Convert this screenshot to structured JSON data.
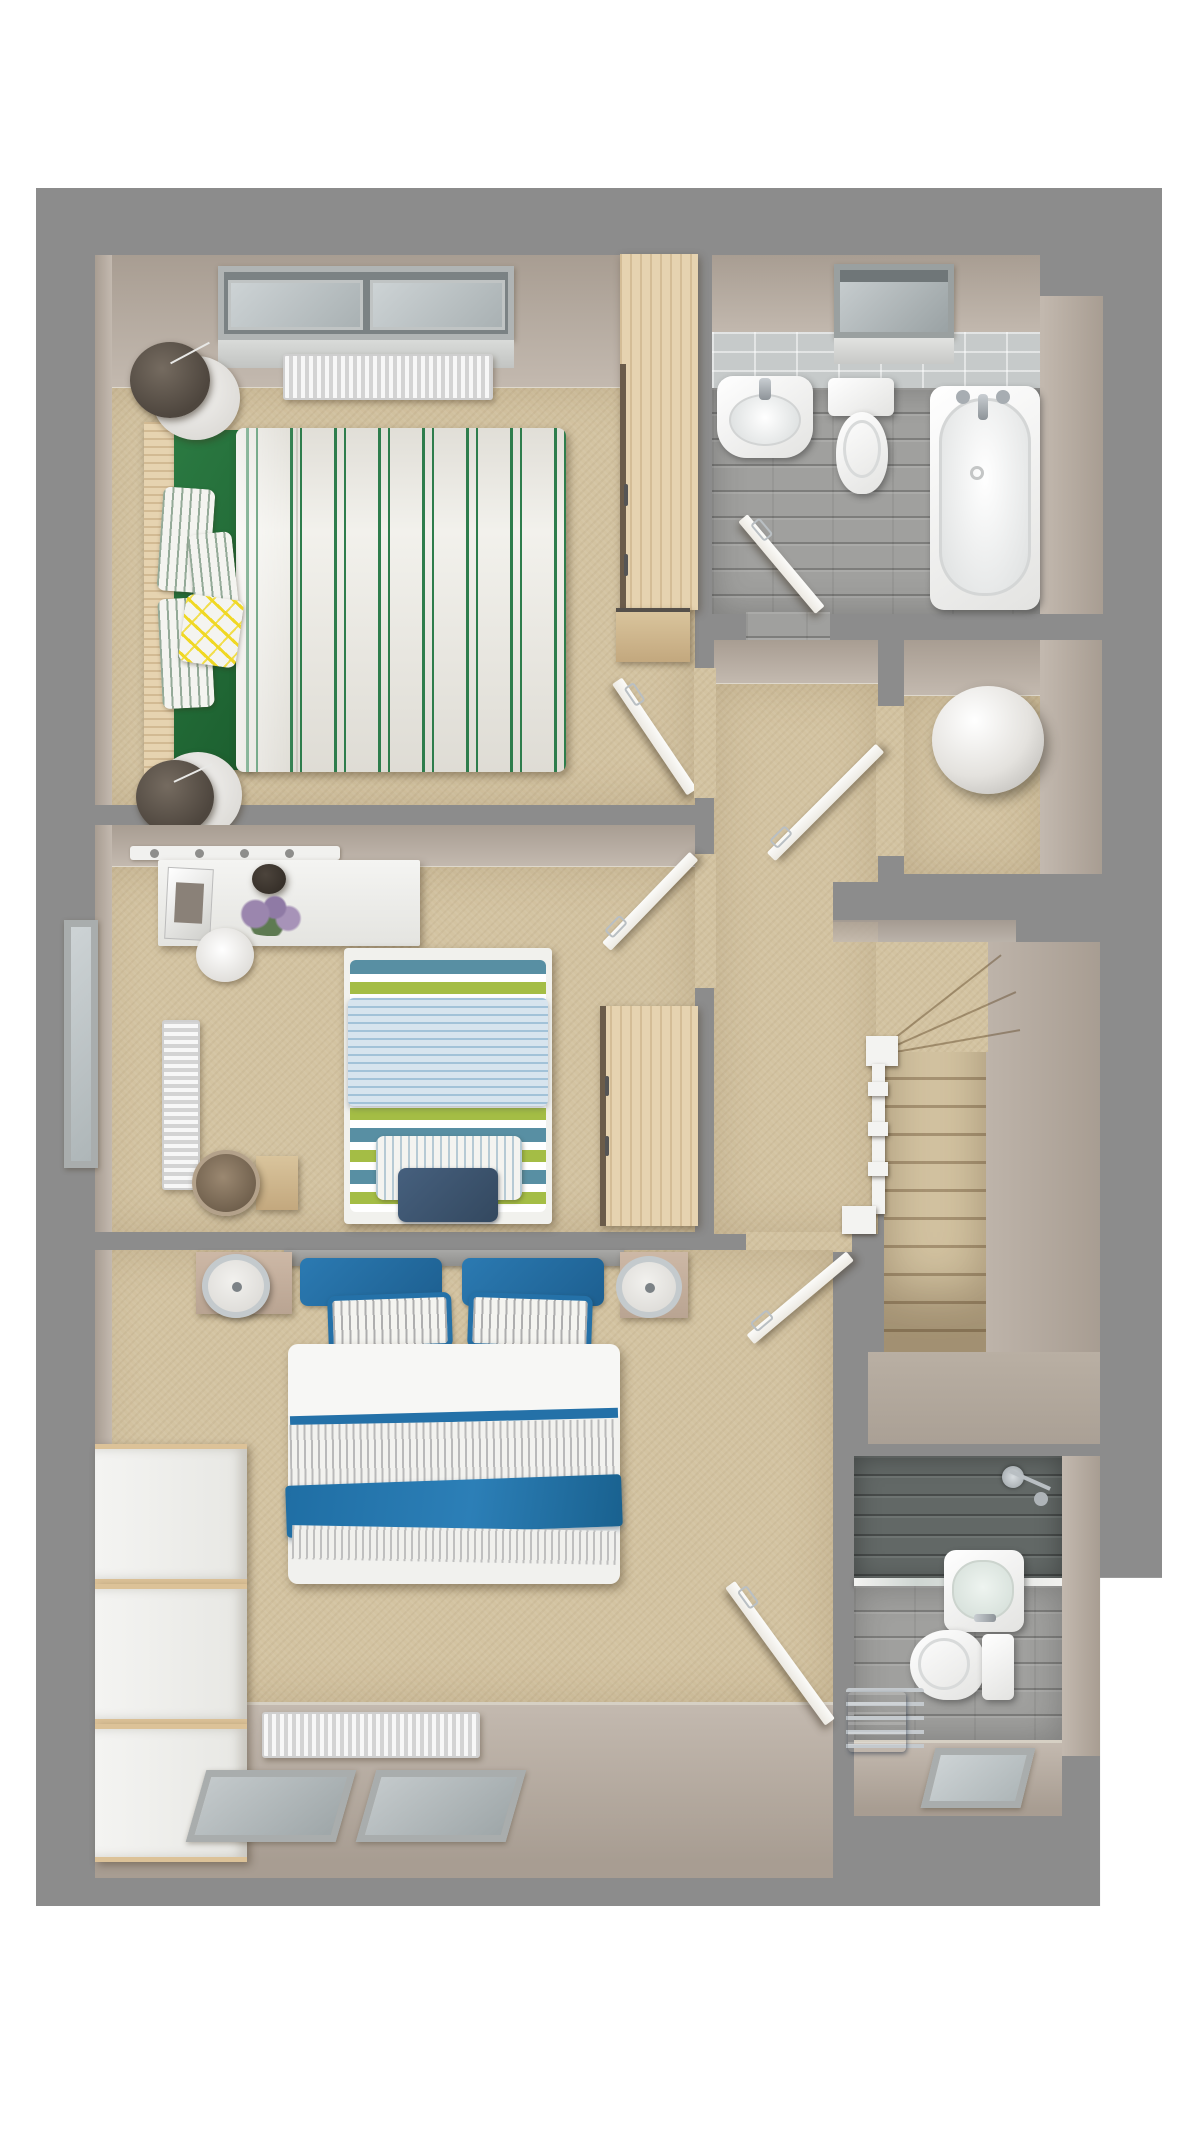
{
  "title": "3D first-floor plan render",
  "palette": {
    "background": "#ffffff",
    "slab": "#8c8c8c",
    "wall_face_dark": "#a89d92",
    "wall_face_light": "#c3b9af",
    "carpet": "#d3c3a1",
    "landing_floor": "#b6aca0",
    "bathroom_plank_floor": "#a0a09e",
    "bathroom_wall_tile": "#c6caca",
    "shower_tile": "#626866",
    "wood_furniture": "#e6d3b0",
    "wood_dark": "#caa97c",
    "duvet_white": "#f6f6f4",
    "stripe_green": "#2e7d4c",
    "sheet_green": "#1f6d35",
    "accent_yellow": "#f0d824",
    "stripe_teal": "#588fa3",
    "stripe_olive": "#a4bd45",
    "quilt_light_blue": "#d3e2ec",
    "cushion_navy": "#3a516b",
    "accent_blue": "#2471a8",
    "towel_blue": "#3f6fb0",
    "chrome": "#b9bfc3",
    "window_glass": "#c3c9cb",
    "window_frame": "#a9adad"
  },
  "rooms": [
    {
      "id": "bedroom-green",
      "furniture": [
        "dormer-window",
        "radiator",
        "double-bed-green-striped-duvet",
        "green-fitted-sheet",
        "striped-pillows",
        "yellow-doodle-cushion",
        "wood-headboard",
        "round-marble-bedside-table-2x",
        "dark-shade-lamp-2x",
        "wood-wardrobe",
        "open-door"
      ]
    },
    {
      "id": "bathroom",
      "furniture": [
        "skylight-window",
        "tiled-wall",
        "pedestal-basin",
        "toilet",
        "bathtub",
        "chrome-taps",
        "plank-tile-floor",
        "open-door"
      ]
    },
    {
      "id": "landing",
      "furniture": [
        "carpet",
        "open-doors",
        "white-balustrade",
        "newel-posts"
      ]
    },
    {
      "id": "airing-cupboard",
      "furniture": [
        "hot-water-cylinder-sphere",
        "open-door"
      ]
    },
    {
      "id": "staircase",
      "furniture": [
        "winder-steps",
        "straight-flight",
        "half-landing",
        "white-handrail"
      ]
    },
    {
      "id": "bedroom-single",
      "furniture": [
        "desk-with-magazine-plant-flowers",
        "knob-rail",
        "round-stool",
        "left-window",
        "vertical-radiator",
        "single-bed-teal-olive-stripes",
        "light-blue-quilt",
        "navy-cushion",
        "wood-wardrobe",
        "woven-basket",
        "side-table",
        "open-door"
      ]
    },
    {
      "id": "bedroom-master",
      "furniture": [
        "double-bed-white-duvet",
        "blue-pillows",
        "pinstripe-pillows",
        "blue-throw",
        "bedside-table-2x",
        "chrome-ring-lamp-2x",
        "white-chest-of-drawers-3x",
        "radiator",
        "dormer-windows-2x",
        "open-door"
      ]
    },
    {
      "id": "en-suite",
      "furniture": [
        "dark-tiled-shower",
        "glass-screen",
        "chrome-shower-set",
        "wall-basin",
        "toilet",
        "towel-rail-with-blue-towel",
        "window",
        "open-door"
      ]
    }
  ]
}
